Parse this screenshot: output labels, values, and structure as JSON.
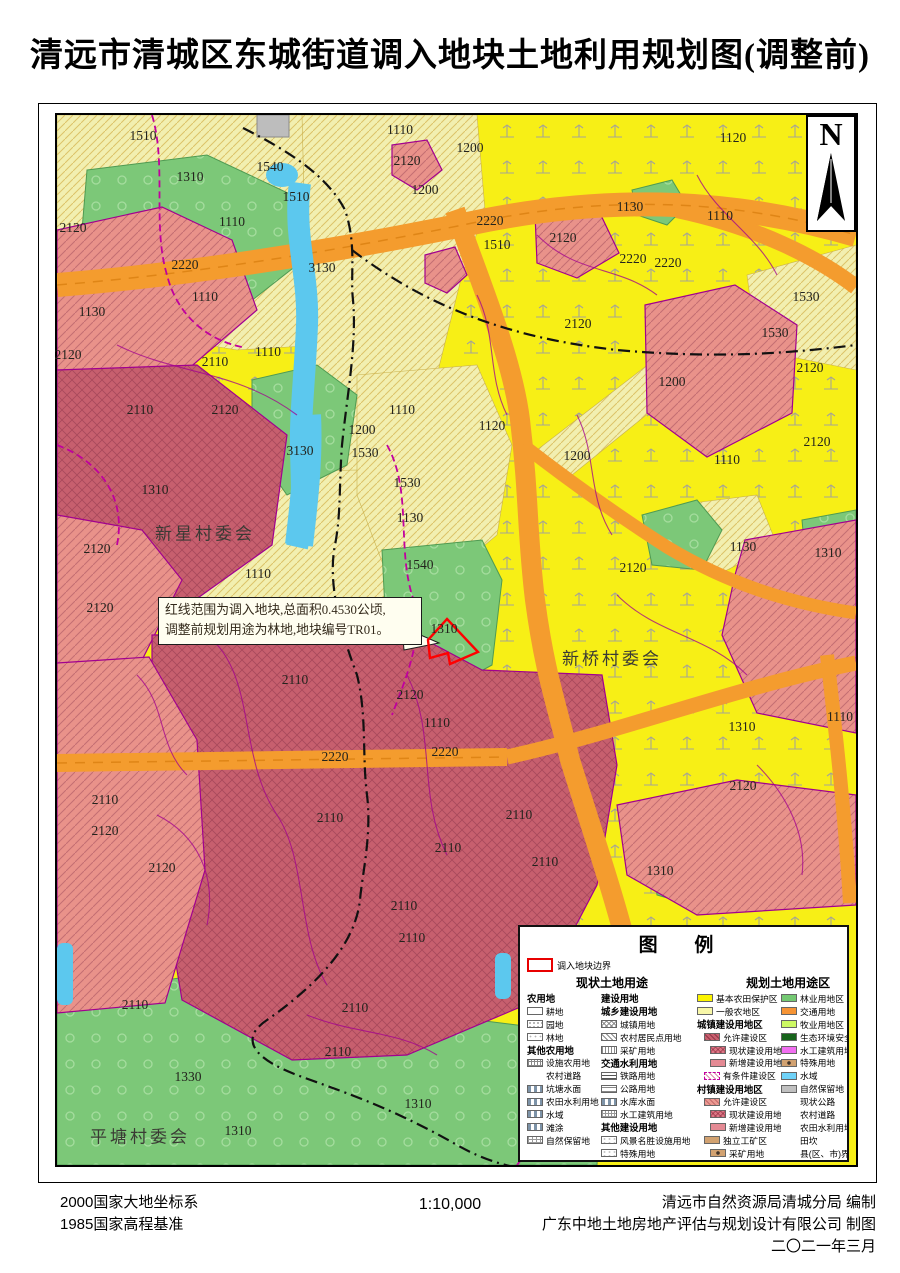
{
  "title": "清远市清城区东城街道调入地块土地利用规划图(调整前)",
  "north_label": "N",
  "annotation": {
    "line1": "红线范围为调入地块,总面积0.4530公顷,",
    "line2": "调整前规划用途为林地,地块编号TR01。"
  },
  "scale": "1:10,000",
  "footer": {
    "datum_line1": "2000国家大地坐标系",
    "datum_line2": "1985国家高程基准",
    "credit_line1": "清远市自然资源局清城分局  编制",
    "credit_line2": "广东中地土地房地产评估与规划设计有限公司  制图",
    "credit_line3": "二〇二一年三月"
  },
  "colors": {
    "basic_farmland_yellow": "#F7EF16",
    "general_agri_pale": "#F2EFB0",
    "forest_green": "#7CC878",
    "urban_rose_light": "#E9928A",
    "urban_rose_dark": "#C75F6E",
    "road_orange": "#F49C2E",
    "water_blue": "#5CC8EE",
    "parcel_magenta": "#A1008F",
    "plot_red": "#FF0000"
  },
  "legend": {
    "title": "图  例",
    "boundary_label": "调入地块边界",
    "current_header": "现状土地用途",
    "planned_header": "规划土地用途区",
    "cols": {
      "a": [
        {
          "h": 1,
          "t": "农用地"
        },
        {
          "s": "s-gengdi",
          "t": "耕地"
        },
        {
          "s": "s-yuandi",
          "t": "园地"
        },
        {
          "s": "s-lindi",
          "t": "林地"
        },
        {
          "h": 1,
          "t": "其他农用地"
        },
        {
          "s": "s-sheshi",
          "t": "设施农用地"
        },
        {
          "s": "ln-ncdl-a",
          "t": "农村道路",
          "line": 1
        },
        {
          "s": "s-kengtang",
          "t": "坑塘水面"
        },
        {
          "s": "s-ntsl-a",
          "t": "农田水利用地"
        },
        {
          "s": "s-shuiyu-a",
          "t": "水域"
        },
        {
          "s": "s-tantu",
          "t": "滩涂"
        },
        {
          "s": "s-zrbl-a",
          "t": "自然保留地"
        }
      ],
      "b": [
        {
          "h": 1,
          "t": "建设用地"
        },
        {
          "h": 1,
          "t": "城乡建设用地"
        },
        {
          "s": "s-chengzhen",
          "t": "城镇用地"
        },
        {
          "s": "s-ncjm",
          "t": "农村居民点用地"
        },
        {
          "s": "s-ckyd-a",
          "t": "采矿用地"
        },
        {
          "h": 1,
          "t": "交通水利用地"
        },
        {
          "s": "s-tielu",
          "t": "铁路用地"
        },
        {
          "s": "s-gonglu",
          "t": "公路用地"
        },
        {
          "s": "s-shuiku",
          "t": "水库水面"
        },
        {
          "s": "s-sgjz-a",
          "t": "水工建筑用地"
        },
        {
          "h": 1,
          "t": "其他建设用地"
        },
        {
          "s": "s-fjms",
          "t": "风景名胜设施用地"
        },
        {
          "s": "s-teshu-a",
          "t": "特殊用地"
        }
      ],
      "c": [
        {
          "s": "s-jbnt",
          "t": "基本农田保护区"
        },
        {
          "s": "s-ybnd",
          "t": "一般农地区"
        },
        {
          "h": 1,
          "t": "城镇建设用地区"
        },
        {
          "s": "s-yxjs-cz",
          "t": "允许建设区",
          "ind": 1
        },
        {
          "s": "s-xzjs",
          "t": "现状建设用地",
          "ind": 2
        },
        {
          "s": "s-xzjs-new",
          "t": "新增建设用地",
          "ind": 2
        },
        {
          "s": "s-ytjjs",
          "t": "有条件建设区",
          "ind": 1
        },
        {
          "h": 1,
          "t": "村镇建设用地区"
        },
        {
          "s": "s-yxjs-cun",
          "t": "允许建设区",
          "ind": 1
        },
        {
          "s": "s-xzjs",
          "t": "现状建设用地",
          "ind": 2
        },
        {
          "s": "s-xzjs-new",
          "t": "新增建设用地",
          "ind": 2
        },
        {
          "s": "s-dlgk",
          "t": "独立工矿区",
          "ind": 1
        },
        {
          "s": "s-ckyd-b",
          "t": "采矿用地",
          "ind": 2
        },
        {
          "s": "s-dljs",
          "t": "独立建设用地",
          "ind": 2
        },
        {
          "s": "s-fljy",
          "t": "风景旅游用地区"
        }
      ],
      "d": [
        {
          "s": "s-lyyd",
          "t": "林业用地区"
        },
        {
          "s": "s-jtyd",
          "t": "交通用地"
        },
        {
          "s": "s-myyd",
          "t": "牧业用地区"
        },
        {
          "s": "s-stkz",
          "t": "生态环境安全控制区"
        },
        {
          "s": "s-sgjz-b",
          "t": "水工建筑用地"
        },
        {
          "s": "s-tsyd",
          "t": "特殊用地"
        },
        {
          "s": "s-shuiyu-b",
          "t": "水域"
        },
        {
          "s": "s-zrbl-b",
          "t": "自然保留地"
        },
        {
          "s": "ln-xzgl",
          "t": "现状公路",
          "line": 1
        },
        {
          "s": "ln-ncdl-b",
          "t": "农村道路",
          "line": 1
        },
        {
          "s": "ln-ntsl-b",
          "t": "农田水利用地",
          "line": 1
        },
        {
          "s": "ln-tk",
          "t": "田坎",
          "line": 1
        },
        {
          "s": "ln-xian",
          "t": "县(区、市)界",
          "line": 1
        },
        {
          "s": "ln-zhen",
          "t": "镇界",
          "line": 1
        },
        {
          "s": "ln-cun",
          "t": "村界",
          "line": 1
        }
      ]
    }
  },
  "map": {
    "villages": [
      {
        "name": "新星村委会",
        "x": 148,
        "y": 417
      },
      {
        "name": "新桥村委会",
        "x": 555,
        "y": 542
      },
      {
        "name": "平塘村委会",
        "x": 83,
        "y": 1020
      }
    ],
    "labels": [
      [
        86,
        21,
        "1510"
      ],
      [
        343,
        15,
        "1110"
      ],
      [
        413,
        33,
        "1200"
      ],
      [
        350,
        46,
        "2120"
      ],
      [
        676,
        23,
        "1120"
      ],
      [
        133,
        62,
        "1310"
      ],
      [
        213,
        52,
        "1540"
      ],
      [
        239,
        82,
        "1510"
      ],
      [
        368,
        75,
        "1200"
      ],
      [
        573,
        92,
        "1130"
      ],
      [
        663,
        101,
        "1110"
      ],
      [
        175,
        107,
        "1110"
      ],
      [
        433,
        106,
        "2220"
      ],
      [
        506,
        123,
        "2120"
      ],
      [
        576,
        144,
        "2220"
      ],
      [
        611,
        148,
        "2220"
      ],
      [
        440,
        130,
        "1510"
      ],
      [
        16,
        113,
        "2120"
      ],
      [
        128,
        150,
        "2220"
      ],
      [
        265,
        153,
        "3130"
      ],
      [
        749,
        182,
        "1530"
      ],
      [
        718,
        218,
        "1530"
      ],
      [
        35,
        197,
        "1130"
      ],
      [
        148,
        182,
        "1110"
      ],
      [
        11,
        240,
        "2120"
      ],
      [
        158,
        247,
        "2110"
      ],
      [
        211,
        237,
        "1110"
      ],
      [
        753,
        253,
        "2120"
      ],
      [
        521,
        209,
        "2120"
      ],
      [
        520,
        341,
        "1200"
      ],
      [
        615,
        267,
        "1200"
      ],
      [
        83,
        295,
        "2110"
      ],
      [
        168,
        295,
        "2120"
      ],
      [
        345,
        295,
        "1110"
      ],
      [
        305,
        315,
        "1200"
      ],
      [
        243,
        336,
        "3130"
      ],
      [
        308,
        338,
        "1530"
      ],
      [
        435,
        311,
        "1120"
      ],
      [
        350,
        368,
        "1530"
      ],
      [
        353,
        403,
        "1130"
      ],
      [
        98,
        375,
        "1310"
      ],
      [
        40,
        434,
        "2120"
      ],
      [
        43,
        493,
        "2120"
      ],
      [
        363,
        450,
        "1540"
      ],
      [
        201,
        459,
        "1110"
      ],
      [
        686,
        432,
        "1130"
      ],
      [
        771,
        438,
        "1310"
      ],
      [
        576,
        453,
        "2120"
      ],
      [
        670,
        345,
        "1110"
      ],
      [
        760,
        327,
        "2120"
      ],
      [
        387,
        514,
        "1310"
      ],
      [
        238,
        565,
        "2110"
      ],
      [
        353,
        580,
        "2120"
      ],
      [
        380,
        608,
        "1110"
      ],
      [
        278,
        642,
        "2220"
      ],
      [
        388,
        637,
        "2220"
      ],
      [
        685,
        612,
        "1310"
      ],
      [
        686,
        671,
        "2120"
      ],
      [
        783,
        602,
        "1110"
      ],
      [
        48,
        685,
        "2110"
      ],
      [
        48,
        716,
        "2120"
      ],
      [
        273,
        703,
        "2110"
      ],
      [
        462,
        700,
        "2110"
      ],
      [
        105,
        753,
        "2120"
      ],
      [
        391,
        733,
        "2110"
      ],
      [
        488,
        747,
        "2110"
      ],
      [
        603,
        756,
        "1310"
      ],
      [
        347,
        791,
        "2110"
      ],
      [
        355,
        823,
        "2110"
      ],
      [
        78,
        890,
        "2110"
      ],
      [
        298,
        893,
        "2110"
      ],
      [
        281,
        937,
        "2110"
      ],
      [
        131,
        962,
        "1330"
      ],
      [
        361,
        989,
        "1310"
      ],
      [
        181,
        1016,
        "1310"
      ]
    ]
  }
}
